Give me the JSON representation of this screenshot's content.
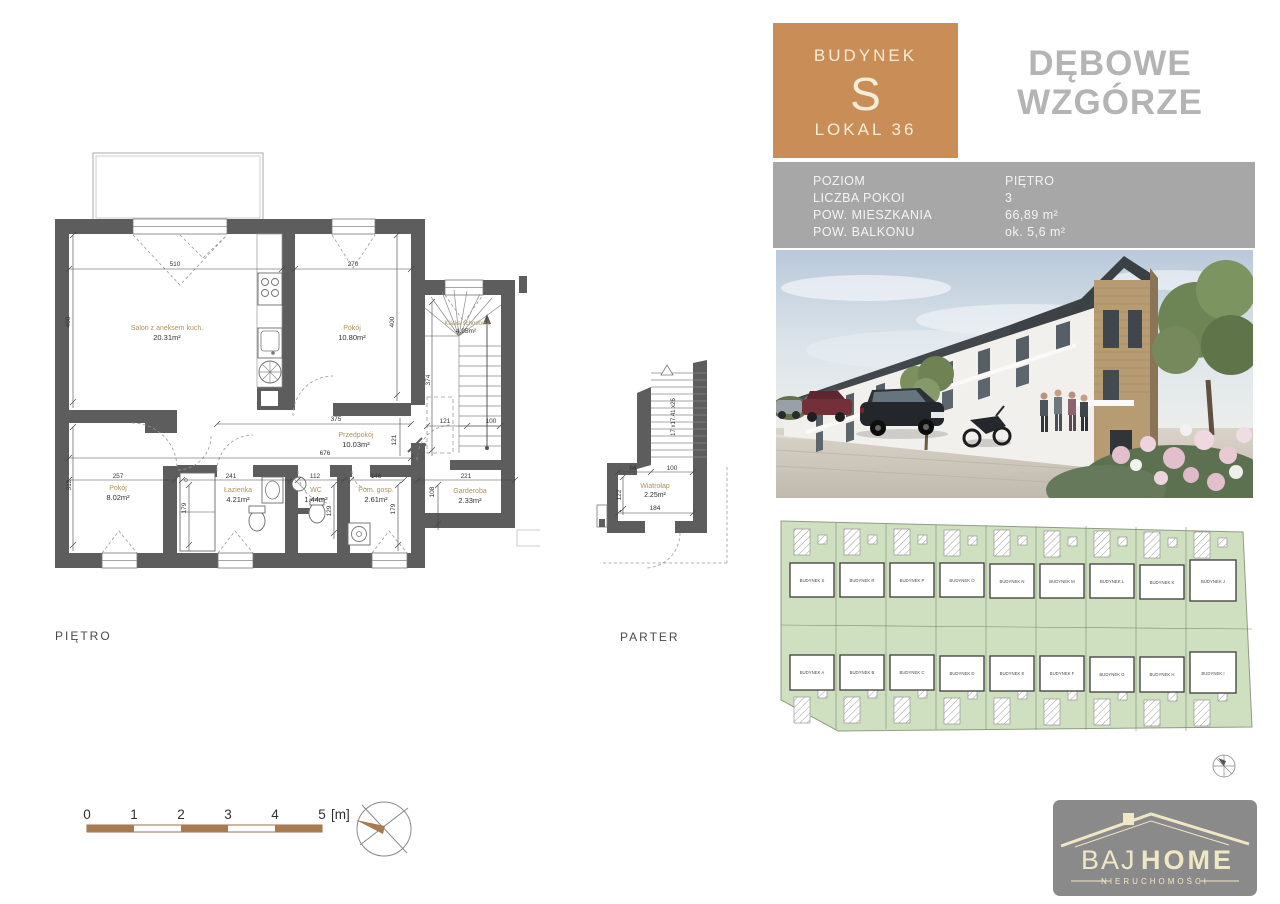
{
  "header": {
    "budynek_label": "BUDYNEK",
    "budynek_letter": "S",
    "lokal": "LOKAL 36",
    "project_line1": "DĘBOWE",
    "project_line2": "WZGÓRZE"
  },
  "info": {
    "rows": [
      {
        "label": "POZIOM",
        "value": "PIĘTRO"
      },
      {
        "label": "LICZBA POKOI",
        "value": "3"
      },
      {
        "label": "POW. MIESZKANIA",
        "value": "66,89 m²"
      },
      {
        "label": "POW. BALKONU",
        "value": "ok. 5,6 m²"
      }
    ]
  },
  "floor_plan": {
    "level_label": "PIĘTRO",
    "rooms": [
      {
        "name": "Salon z aneksem kuch.",
        "area": "20.31m²"
      },
      {
        "name": "Pokój",
        "area": "10.80m²"
      },
      {
        "name": "Klatka schodowa",
        "area": "4.95m²"
      },
      {
        "name": "Przedpokój",
        "area": "10.03m²"
      },
      {
        "name": "Pokój",
        "area": "8.02m²"
      },
      {
        "name": "Łazienka",
        "area": "4.21m²"
      },
      {
        "name": "WC",
        "area": "1.44m²"
      },
      {
        "name": "Pom. gosp.",
        "area": "2.61m²"
      },
      {
        "name": "Garderoba",
        "area": "2.33m²"
      }
    ],
    "dims": {
      "top_salon": "510",
      "top_pokoj": "270",
      "left_upper": "400",
      "right_pokoj": "400",
      "wing_height": "374",
      "hall_width": "375",
      "hall_total": "676",
      "hall_depth": "121",
      "stair_121": "121",
      "stair_100": "100",
      "gard_width": "221",
      "left_lower": "312",
      "bot_pokoj": "257",
      "bot_lazienka": "241",
      "lazienka_depth": "179",
      "bot_wc": "112",
      "wc_depth": "129",
      "bot_pomgosp": "146",
      "pomgosp_depth": "179",
      "gard_depth": "108"
    }
  },
  "parter_plan": {
    "level_label": "PARTER",
    "room": {
      "name": "Wiatrołap",
      "area": "2.25m²"
    },
    "stairs_note": "17 x17.41 x26",
    "dims": {
      "d84": "84",
      "d100": "100",
      "d122": "122",
      "d184": "184"
    }
  },
  "site_plan": {
    "top_row": [
      "BUDYNEK S",
      "BUDYNEK R",
      "BUDYNEK P",
      "BUDYNEK O",
      "BUDYNEK N",
      "BUDYNEK M",
      "BUDYNEK L",
      "BUDYNEK K",
      "BUDYNEK J"
    ],
    "bottom_row": [
      "BUDYNEK A",
      "BUDYNEK B",
      "BUDYNEK C",
      "BUDYNEK D",
      "BUDYNEK E",
      "BUDYNEK F",
      "BUDYNEK G",
      "BUDYNEK H",
      "BUDYNEK I"
    ],
    "highlighted": "BUDYNEK S"
  },
  "scale_bar": {
    "ticks": [
      "0",
      "1",
      "2",
      "3",
      "4",
      "5"
    ],
    "unit": "[m]"
  },
  "logo": {
    "name_part1": "BAJ",
    "name_part2": "HOME",
    "subtitle": "NIERUCHOMOŚCI"
  },
  "colors": {
    "accent_orange": "#c98e57",
    "title_gray": "#b4b4b4",
    "info_bar_gray": "#a7a7a7",
    "wall_gray": "#5d5d5d",
    "room_label_tan": "#ab945c",
    "site_green": "#cfe0c0",
    "site_highlight": "#d89a64",
    "logo_bg": "#8a8a8a",
    "logo_text": "#f0e7c5",
    "scale_brown": "#a87a50"
  }
}
